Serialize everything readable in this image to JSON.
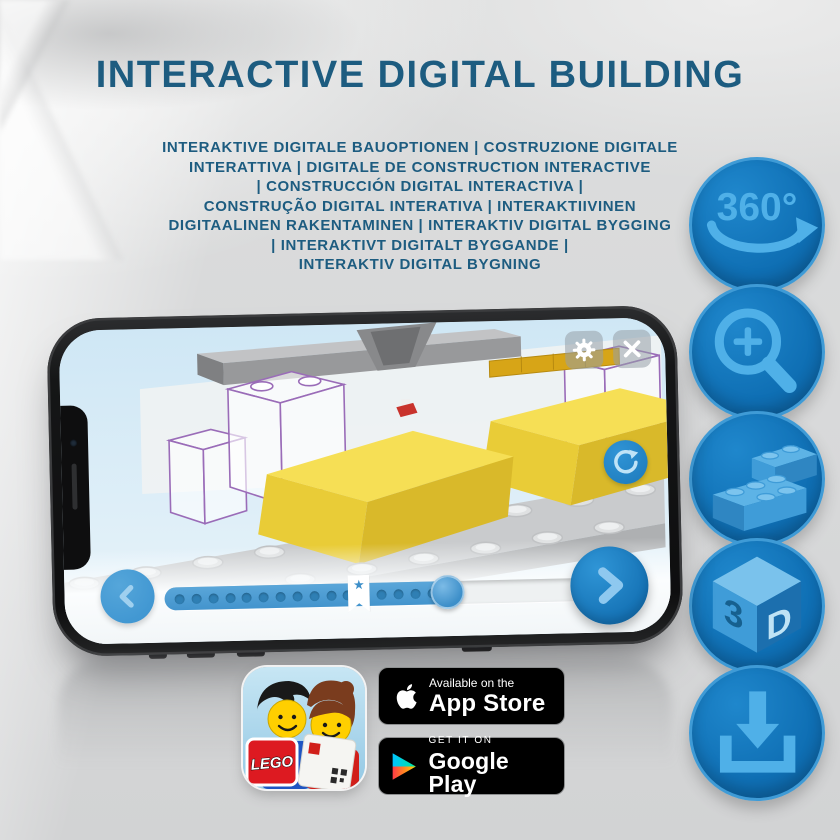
{
  "header": {
    "title": "INTERACTIVE DIGITAL BUILDING",
    "subtitle_lines": [
      "INTERAKTIVE DIGITALE BAUOPTIONEN | COSTRUZIONE DIGITALE",
      "INTERATTIVA | DIGITALE DE CONSTRUCTION INTERACTIVE",
      "| CONSTRUCCIÓN DIGITAL INTERACTIVA |",
      "CONSTRUÇÃO DIGITAL INTERATIVA | INTERAKTIIVINEN",
      "DIGITAALINEN RAKENTAMINEN | INTERAKTIV DIGITAL BYGGING",
      "| INTERAKTIVT DIGITALT BYGGANDE |",
      "INTERAKTIV DIGITAL BYGNING"
    ]
  },
  "feature_icons": {
    "rotation_label": "360°",
    "cube_left": "3",
    "cube_right": "D"
  },
  "phone_app": {
    "slider": {
      "progress_percent": 64,
      "bookmark_star": "★",
      "dot_count": 16
    }
  },
  "badges": {
    "app_icon_logo": "LEGO",
    "app_store": {
      "tagline": "Available on the",
      "store": "App Store"
    },
    "google_play": {
      "tagline": "GET IT ON",
      "store": "Google Play"
    }
  },
  "colors": {
    "title_blue": "#1d5c80",
    "icon_circle_blue": "#0f6fb4",
    "icon_glyph_blue": "#4fb0e8",
    "app_button_blue": "#3d8fc9",
    "brick_yellow": "#f4dc52",
    "ghost_outline_purple": "#9a6cb8"
  }
}
